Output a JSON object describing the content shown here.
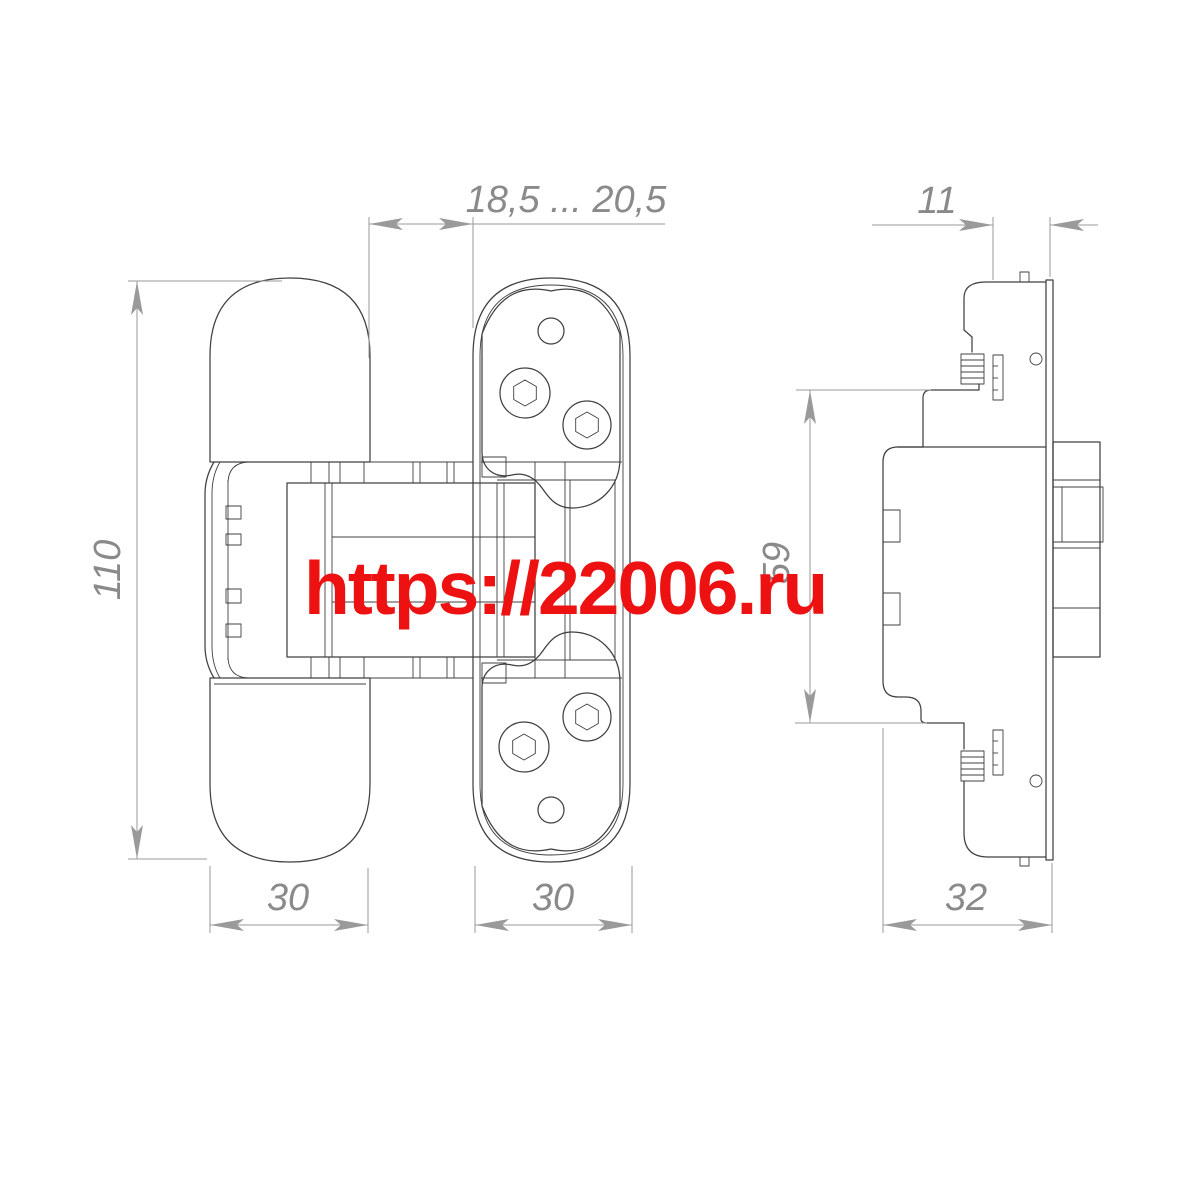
{
  "drawing": {
    "title": "concealed-hinge-technical-drawing",
    "watermark": {
      "text": "https://22006.ru",
      "color": "#ee1111"
    },
    "dimensions": {
      "gap_range": {
        "label": "18,5 ... 20,5"
      },
      "plate_depth": {
        "label": "11"
      },
      "overall_height": {
        "label": "110"
      },
      "body_height": {
        "label": "59"
      },
      "leaf_width": {
        "label": "30"
      },
      "frame_width": {
        "label": "30"
      },
      "side_depth": {
        "label": "32"
      }
    },
    "colors": {
      "outline": "#404040",
      "dimension": "#9a9a9a",
      "dimension_text": "#8a8a8a",
      "watermark": "#ee1111",
      "background": "#ffffff"
    }
  }
}
